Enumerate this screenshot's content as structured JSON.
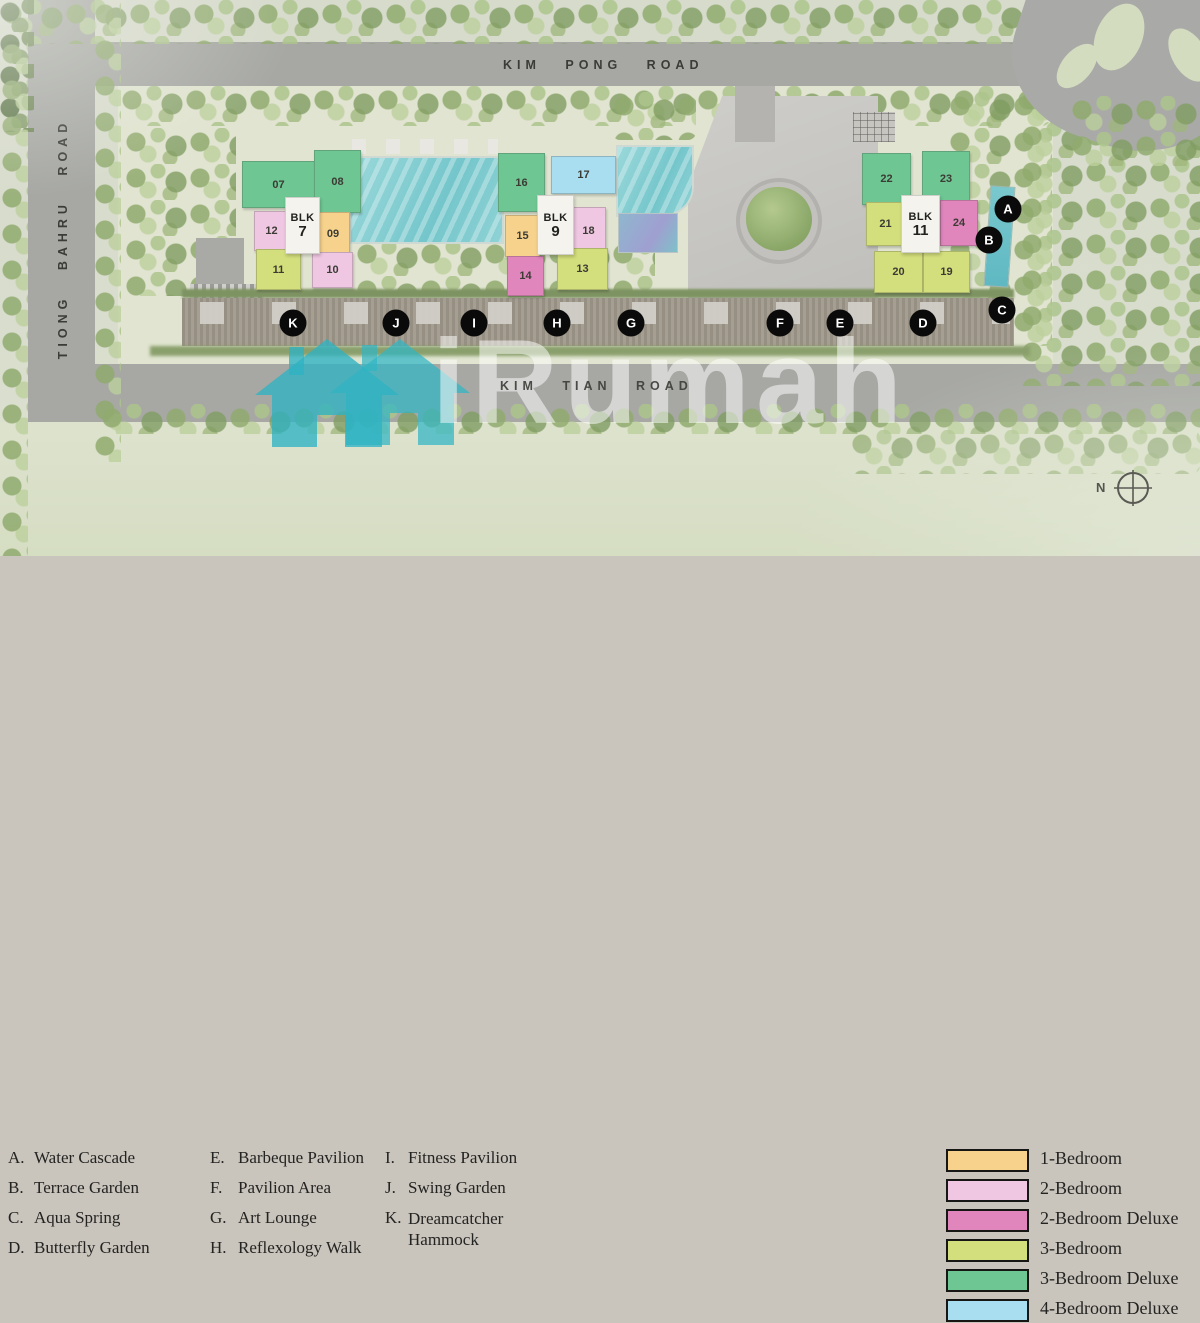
{
  "map": {
    "roads": {
      "kim_pong": "KIM PONG ROAD",
      "tiong_bahru": "TIONG BAHRU ROAD",
      "kim_tian": "KIM TIAN ROAD"
    },
    "compass": {
      "label": "N"
    },
    "blocks": [
      {
        "label": "BLK",
        "number": "7",
        "units": [
          {
            "no": "07",
            "type": "3-Bedroom Deluxe"
          },
          {
            "no": "08",
            "type": "3-Bedroom Deluxe"
          },
          {
            "no": "09",
            "type": "1-Bedroom"
          },
          {
            "no": "10",
            "type": "2-Bedroom"
          },
          {
            "no": "11",
            "type": "3-Bedroom"
          },
          {
            "no": "12",
            "type": "2-Bedroom"
          }
        ]
      },
      {
        "label": "BLK",
        "number": "9",
        "units": [
          {
            "no": "13",
            "type": "3-Bedroom"
          },
          {
            "no": "14",
            "type": "2-Bedroom Deluxe"
          },
          {
            "no": "15",
            "type": "1-Bedroom"
          },
          {
            "no": "16",
            "type": "3-Bedroom Deluxe"
          },
          {
            "no": "17",
            "type": "4-Bedroom Deluxe"
          },
          {
            "no": "18",
            "type": "2-Bedroom"
          }
        ]
      },
      {
        "label": "BLK",
        "number": "11",
        "units": [
          {
            "no": "19",
            "type": "3-Bedroom"
          },
          {
            "no": "20",
            "type": "3-Bedroom"
          },
          {
            "no": "21",
            "type": "3-Bedroom"
          },
          {
            "no": "22",
            "type": "3-Bedroom Deluxe"
          },
          {
            "no": "23",
            "type": "3-Bedroom Deluxe"
          },
          {
            "no": "24",
            "type": "2-Bedroom Deluxe"
          }
        ]
      }
    ],
    "markers": [
      "A",
      "B",
      "C",
      "D",
      "E",
      "F",
      "G",
      "H",
      "I",
      "J",
      "K"
    ]
  },
  "watermark": {
    "text": "iRumah",
    "house_color": "#31b5c5"
  },
  "legend": {
    "facilities": [
      {
        "key": "A.",
        "label": "Water Cascade"
      },
      {
        "key": "B.",
        "label": "Terrace Garden"
      },
      {
        "key": "C.",
        "label": "Aqua Spring"
      },
      {
        "key": "D.",
        "label": "Butterfly Garden"
      },
      {
        "key": "E.",
        "label": "Barbeque Pavilion"
      },
      {
        "key": "F.",
        "label": "Pavilion Area"
      },
      {
        "key": "G.",
        "label": "Art Lounge"
      },
      {
        "key": "H.",
        "label": "Reflexology Walk"
      },
      {
        "key": "I.",
        "label": "Fitness Pavilion"
      },
      {
        "key": "J.",
        "label": "Swing Garden"
      },
      {
        "key": "K.",
        "label": "Dreamcatcher Hammock"
      }
    ],
    "unit_types": [
      {
        "label": "1-Bedroom",
        "color": "#f7d28d"
      },
      {
        "label": "2-Bedroom",
        "color": "#efc7e2"
      },
      {
        "label": "2-Bedroom Deluxe",
        "color": "#e086bd"
      },
      {
        "label": "3-Bedroom",
        "color": "#d3de7c"
      },
      {
        "label": "3-Bedroom Deluxe",
        "color": "#6ec693"
      },
      {
        "label": "4-Bedroom Deluxe",
        "color": "#a9def1"
      }
    ]
  }
}
